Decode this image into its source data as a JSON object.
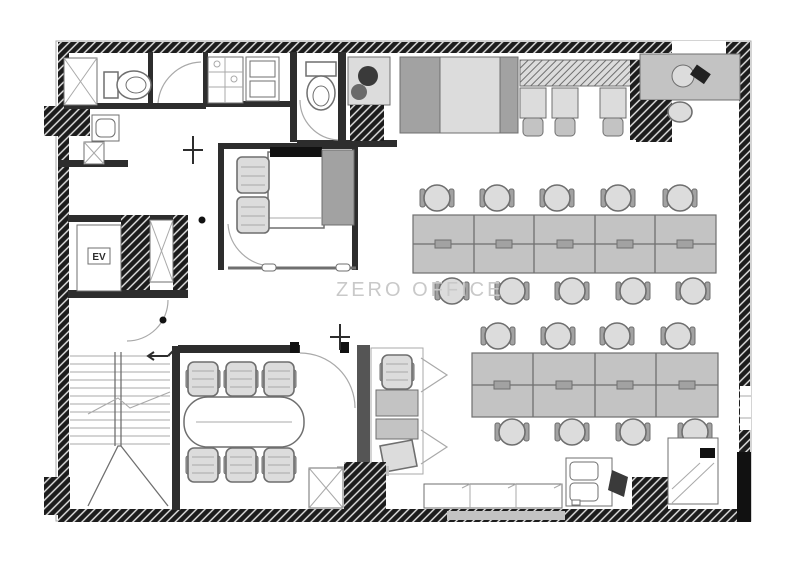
{
  "page": {
    "width": 787,
    "height": 568,
    "background": "#ffffff"
  },
  "watermark": {
    "text": "ZERO OFFICE",
    "color": "#c9c9c9"
  },
  "labels": {
    "elevator": "EV"
  },
  "palette": {
    "wall": "#1c1c1c",
    "wall_hatch": "#e8e8e8",
    "ink": "#2d2d2d",
    "black": "#111111",
    "line_mid": "#6f6f6f",
    "line_light": "#a9a9a9",
    "gray_dark": "#a2a2a2",
    "gray_mid": "#c3c3c3",
    "gray_light": "#dcdcdc",
    "watermark": "#c9c9c9"
  },
  "floorplan": {
    "type": "office-floor-plan",
    "areas": [
      "washroom",
      "shower",
      "toilets",
      "kitchenette",
      "pantry",
      "nap-room",
      "elevator-core",
      "service-shafts",
      "staircase",
      "meeting-room",
      "phone-booths",
      "open-office",
      "counter-seating",
      "kitchen-counter",
      "copier-corner",
      "credenza"
    ],
    "open_office": {
      "bench_rows": [
        {
          "name": "bench-row-upper",
          "desk_segments": 5,
          "chairs_top": 5,
          "chairs_bottom": 5
        },
        {
          "name": "bench-row-lower",
          "desk_segments": 4,
          "chairs_top": 4,
          "chairs_bottom": 4
        }
      ]
    },
    "meeting_room": {
      "tables": 1,
      "seats": 6
    },
    "counter_seating": {
      "stools": 3
    },
    "phone_booths": {
      "count": 2
    },
    "nap_room": {
      "beds": 1,
      "armchairs": 2
    },
    "elevator": {
      "count": 1
    },
    "staircase": {
      "count": 1
    }
  }
}
